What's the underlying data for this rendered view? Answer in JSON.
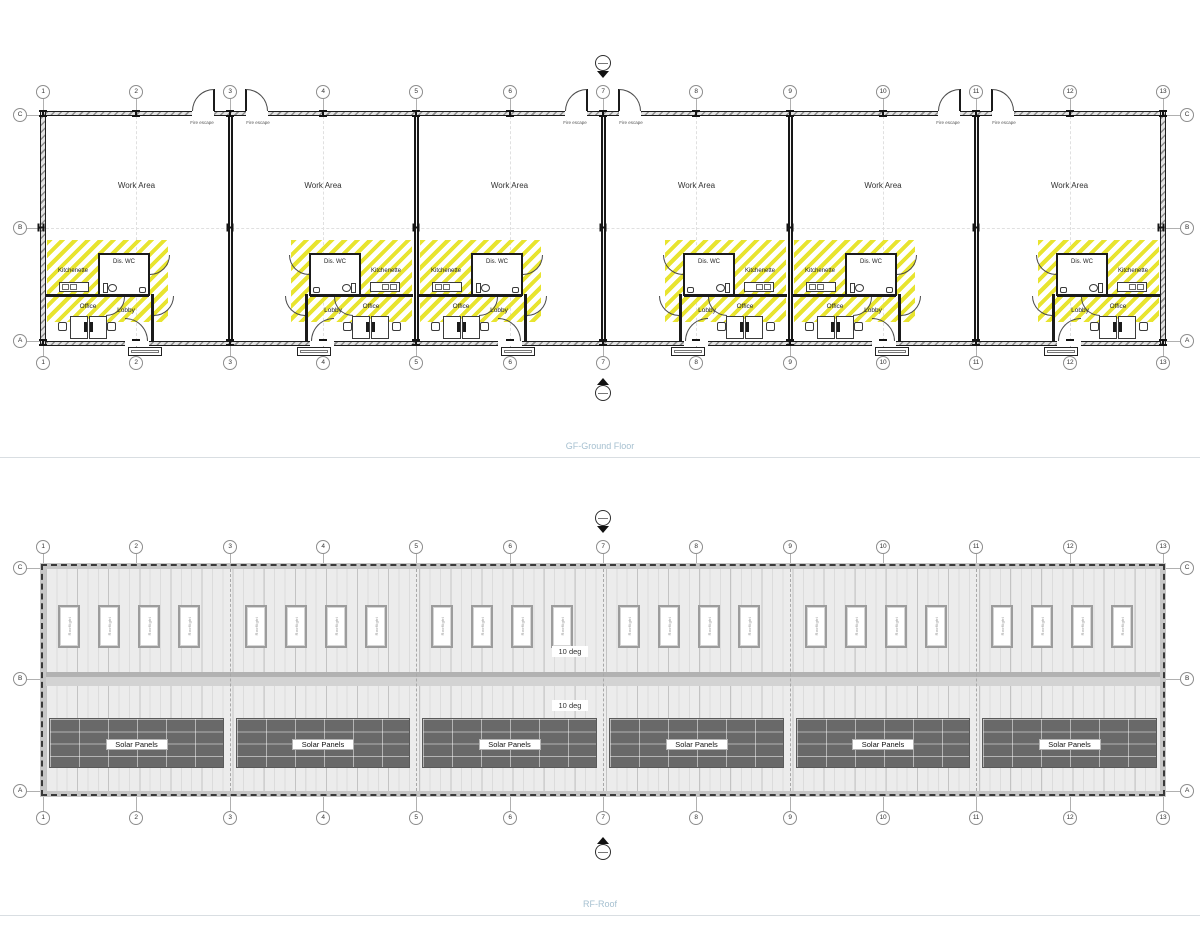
{
  "titles": {
    "ground_floor": "GF-Ground Floor",
    "roof": "RF-Roof"
  },
  "grid": {
    "columns": [
      "1",
      "2",
      "3",
      "4",
      "5",
      "6",
      "7",
      "8",
      "9",
      "10",
      "11",
      "12",
      "13"
    ],
    "rows": [
      "C",
      "B",
      "A"
    ]
  },
  "ground_floor": {
    "fire_escape_label": "Fire escape",
    "units": [
      {
        "id": "Unit 1",
        "mirrored": false,
        "work_area_label": "Work Area",
        "kitchenette_label": "Kitchenette",
        "wc_label": "Dis. WC",
        "office_label": "Office",
        "lobby_label": "Lobby"
      },
      {
        "id": "Unit 2",
        "mirrored": true,
        "work_area_label": "Work Area",
        "kitchenette_label": "Kitchenette",
        "wc_label": "Dis. WC",
        "office_label": "Office",
        "lobby_label": "Lobby"
      },
      {
        "id": "Unit 3",
        "mirrored": false,
        "work_area_label": "Work Area",
        "kitchenette_label": "Kitchenette",
        "wc_label": "Dis. WC",
        "office_label": "Office",
        "lobby_label": "Lobby"
      },
      {
        "id": "Unit 4",
        "mirrored": true,
        "work_area_label": "Work Area",
        "kitchenette_label": "Kitchenette",
        "wc_label": "Dis. WC",
        "office_label": "Office",
        "lobby_label": "Lobby"
      },
      {
        "id": "Unit 5",
        "mirrored": false,
        "work_area_label": "Work Area",
        "kitchenette_label": "Kitchenette",
        "wc_label": "Dis. WC",
        "office_label": "Office",
        "lobby_label": "Lobby"
      },
      {
        "id": "Unit 6",
        "mirrored": true,
        "work_area_label": "Work Area",
        "kitchenette_label": "Kitchenette",
        "wc_label": "Dis. WC",
        "office_label": "Office",
        "lobby_label": "Lobby"
      }
    ],
    "fire_escape_grid_positions": [
      "3",
      "7",
      "11"
    ]
  },
  "roof": {
    "rooflight_label": "Rooflight",
    "rooflights_per_unit": 4,
    "slope_labels": [
      "10 deg",
      "10 deg"
    ],
    "solar_panels": [
      {
        "label": "Solar Panels"
      },
      {
        "label": "Solar Panels"
      },
      {
        "label": "Solar Panels"
      },
      {
        "label": "Solar Panels"
      },
      {
        "label": "Solar Panels"
      },
      {
        "label": "Solar Panels"
      }
    ]
  },
  "colors": {
    "hatch_yellow": "#e8e42f",
    "title_blue": "#a6c0d0",
    "solar_panel_gray": "#696969",
    "roof_fill": "#ececec",
    "wall_dark": "#1b1b1b"
  }
}
